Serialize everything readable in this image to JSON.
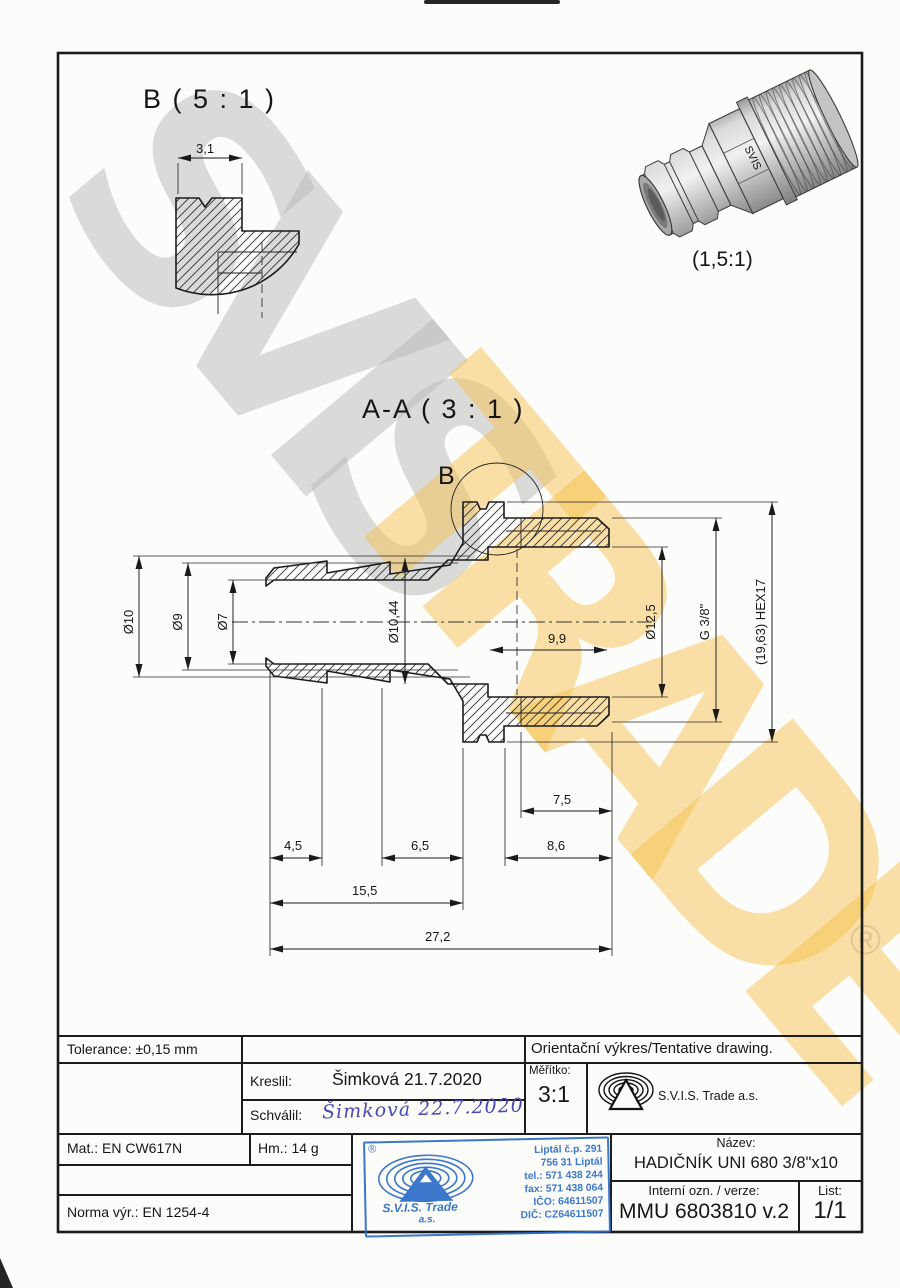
{
  "detail_b": {
    "title": "B ( 5 : 1 )",
    "width": "3,1"
  },
  "iso_view": {
    "scale": "(1,5:1)",
    "engraving": "SVIS"
  },
  "section": {
    "title": "A-A ( 3 : 1 )",
    "marker": "B",
    "dims": {
      "od10": "Ø10",
      "od9": "Ø9",
      "od7": "Ø7",
      "d1044": "Ø10,44",
      "depth99": "9,9",
      "d125": "Ø12,5",
      "g38": "G 3/8\"",
      "hex": "(19,63) HEX17",
      "r75": "7,5",
      "l45": "4,5",
      "l65": "6,5",
      "l86": "8,6",
      "l155": "15,5",
      "l272": "27,2"
    }
  },
  "title_block": {
    "tolerance": "Tolerance: ±0,15 mm",
    "drawn_label": "Kreslil:",
    "drawn_value": "Šimková 21.7.2020",
    "approved_label": "Schválil:",
    "approved_signature": "Šimková 22.7.2020",
    "scale_label": "Měřítko:",
    "scale_value": "3:1",
    "note": "Orientační výkres/Tentative drawing.",
    "company": "S.V.I.S. Trade a.s.",
    "material": "Mat.: EN CW617N",
    "weight": "Hm.: 14 g",
    "standard": "Norma výr.: EN 1254-4",
    "name_label": "Název:",
    "name_value": "HADIČNÍK UNI 680 3/8\"x10",
    "internal_label": "Interní ozn. / verze:",
    "internal_value": "MMU 6803810 v.2",
    "sheet_label": "List:",
    "sheet_value": "1/1"
  },
  "stamp": {
    "registered": "®",
    "company": "S.V.I.S. Trade",
    "suffix": "a.s.",
    "address": [
      "Liptál č.p. 291",
      "756 31 Liptál",
      "tel.: 571 438 244",
      "fax: 571 438 064",
      "IČO: 64611507",
      "DIČ: CZ64611507"
    ]
  },
  "watermark": {
    "part1": "SVIS",
    "part2": "TRADE",
    "registered": "®"
  },
  "colors": {
    "line": "#1c1c1c",
    "stamp_blue": "#2b6cc8",
    "signature_blue": "#4a4ab2",
    "watermark_gray": "#b8b8b8",
    "watermark_yellow": "#f6c150"
  }
}
